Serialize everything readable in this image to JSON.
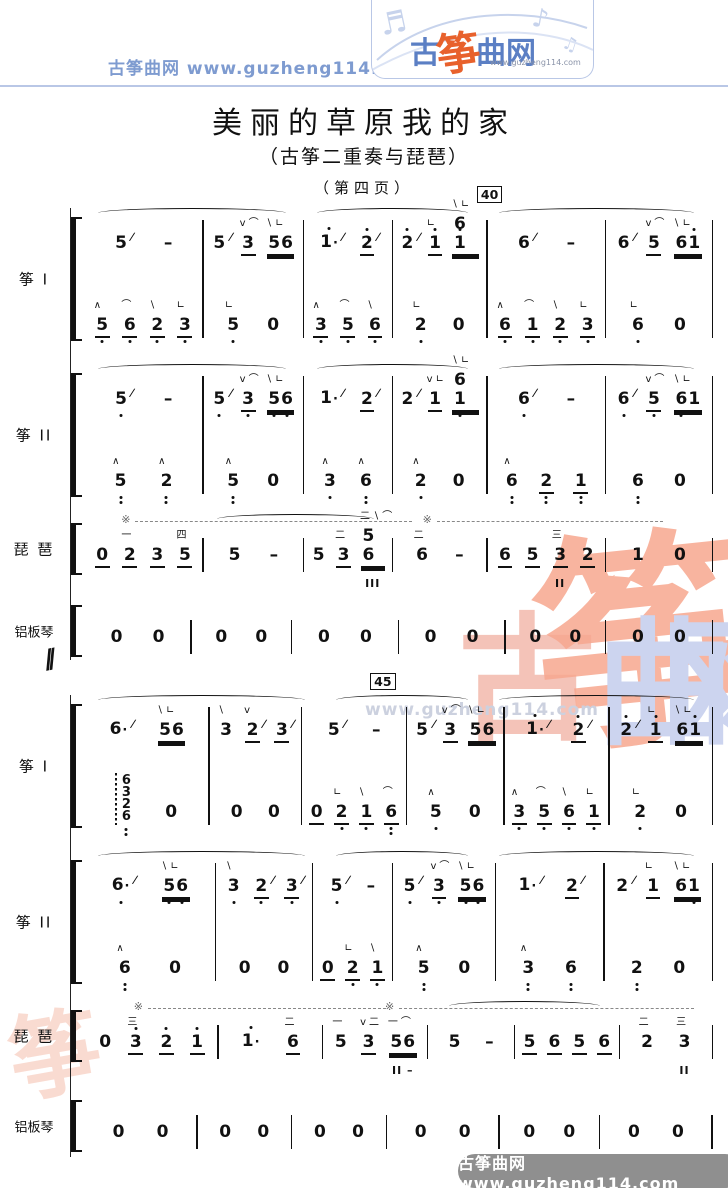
{
  "header": {
    "brand": "古筝曲网",
    "url": "www.guzheng114.com",
    "logo": {
      "gu": "古",
      "zheng": "筝",
      "quwang": "曲网",
      "url": "www.guzheng114.com"
    },
    "accent_blue": "#5b7fc4",
    "accent_orange": "#e8612c",
    "line_blue": "#b9c7e6"
  },
  "title": {
    "main": "美丽的草原我的家",
    "subtitle": "（古筝二重奏与琵琶）",
    "page_note": "（第四页）"
  },
  "watermark": {
    "gu": "古",
    "zheng": "筝",
    "qu": "曲",
    "wang": "网",
    "url": "www.guzheng114.com",
    "swirl": "筝",
    "pink": "#f4c3b8",
    "salmon": "#f7a78f",
    "lavender": "#ccd4ef"
  },
  "footer": {
    "text": "古筝曲网  www.guzheng114.com",
    "bg": "#8f8f8f"
  },
  "break_mark": "∕∕",
  "score": {
    "systems": [
      {
        "measure_box": {
          "text": "40",
          "before_measure": 4
        },
        "parts": [
          {
            "id": "zheng1",
            "label": "筝 I",
            "type": "grand",
            "slurs": [
              [
                0,
                1
              ],
              [
                2,
                3
              ],
              [
                4,
                5
              ]
            ],
            "upper": [
              [
                "5/",
                "-"
              ],
              [
                "5/",
                "{v⌒}3_",
                "{∖∟}56__"
              ],
              [
                "1'./",
                "2'_/"
              ],
              [
                "2'/",
                "{∟}1'_",
                "{∖∟}61'__"
              ],
              [
                "6/",
                "-"
              ],
              [
                "6/",
                "{v⌒}5_",
                "{∖∟}61'__"
              ]
            ],
            "lower": [
              [
                "{∧}5,_",
                "{⌒}6,_",
                "{∖}2,_",
                "{∟}3,_"
              ],
              [
                "{∟}5,",
                "0"
              ],
              [
                "{∧}3,_",
                "{⌒}5,_",
                "{∖}6,_"
              ],
              [
                "{∟}2,",
                "0"
              ],
              [
                "{∧}6,_",
                "{⌒}1,_",
                "{∖}2,_",
                "{∟}3,_"
              ],
              [
                "{∟}6,",
                "0"
              ]
            ]
          },
          {
            "id": "zheng2",
            "label": "筝 II",
            "type": "grand",
            "slurs": [
              [
                0,
                1
              ],
              [
                2,
                3
              ],
              [
                4,
                5
              ]
            ],
            "upper": [
              [
                "5,/",
                "-"
              ],
              [
                "5,/",
                "{v⌒}3,_",
                "{∖∟}5,6,__"
              ],
              [
                "1./",
                "2_/"
              ],
              [
                "2/",
                "{v∟}1_",
                "{∖∟}61,__"
              ],
              [
                "6,/",
                "-"
              ],
              [
                "6,/",
                "{v⌒}5,_",
                "{∖∟}6,1__"
              ]
            ],
            "lower": [
              [
                "{∧}5,,",
                "{∧}2,,"
              ],
              [
                "{∧}5,,",
                "0"
              ],
              [
                "{∧}3,",
                "{∧}6,,"
              ],
              [
                "{∧}2,",
                "0"
              ],
              [
                "{∧}6,,",
                "2,,_",
                "1,,_"
              ],
              [
                "6,,",
                "0"
              ]
            ]
          },
          {
            "id": "pipa",
            "label": "琵 琶",
            "type": "single",
            "slurs": [
              [
                1,
                2
              ]
            ],
            "pedals": [
              {
                "left": 8,
                "width": 44
              },
              {
                "left": 56,
                "width": 36
              }
            ],
            "line": [
              [
                "0_",
                "{一}2_",
                "3_",
                "{四}5_"
              ],
              [
                "5",
                "-"
              ],
              [
                "5",
                "{二}3_",
                {
                  "t": "{二∖⌒}56__",
                  "below": "III"
                }
              ],
              [
                "{二}6",
                "-"
              ],
              [
                "6_",
                "5_",
                {
                  "t": "{三}3_",
                  "below": "II"
                },
                "2_"
              ],
              [
                "1",
                "0"
              ]
            ]
          },
          {
            "id": "ban",
            "label": "铝板琴",
            "type": "single",
            "line": [
              [
                "0",
                "0"
              ],
              [
                "0",
                "0"
              ],
              [
                "0",
                "0"
              ],
              [
                "0",
                "0"
              ],
              [
                "0",
                "0"
              ],
              [
                "0",
                "0"
              ]
            ]
          }
        ]
      },
      {
        "measure_box": {
          "text": "45",
          "before_measure": 3
        },
        "parts": [
          {
            "id": "zheng1",
            "label": "筝 I",
            "type": "grand",
            "slurs": [
              [
                0,
                1
              ],
              [
                2,
                3
              ],
              [
                4,
                5
              ]
            ],
            "upper": [
              [
                "6./",
                "{∖∟}56__"
              ],
              [
                "{∖}3",
                "{v}2_/",
                "3_/"
              ],
              [
                "5/",
                "-"
              ],
              [
                "5/",
                "{v⌒}3_",
                "{∖∟}56__"
              ],
              [
                "1'./",
                "2'_/"
              ],
              [
                "2'/",
                "{∟}1'_",
                "{∖∟}61'__"
              ]
            ],
            "lower": [
              [
                {
                  "chord": [
                    "6",
                    "3",
                    "2",
                    "6,,"
                  ]
                },
                "0"
              ],
              [
                "0",
                "0"
              ],
              [
                "0_",
                "{∟}2,_",
                "{∖}1,_",
                "{⌒}6,,_"
              ],
              [
                "{∧}5,",
                "0"
              ],
              [
                "{∧}3,_",
                "{⌒}5,_",
                "{∖}6,_",
                "{∟}1,_"
              ],
              [
                "{∟}2,",
                "0"
              ]
            ]
          },
          {
            "id": "zheng2",
            "label": "筝 II",
            "type": "grand",
            "slurs": [
              [
                0,
                1
              ],
              [
                2,
                3
              ],
              [
                4,
                5
              ]
            ],
            "upper": [
              [
                "6,./",
                "{∖∟}5,6,__"
              ],
              [
                "{∖}3,",
                "2,_/",
                "3,_/"
              ],
              [
                "5,/",
                "-"
              ],
              [
                "5,/",
                "{v⌒}3,_",
                "{∖∟}5,6,__"
              ],
              [
                "1./",
                "2_/"
              ],
              [
                "2/",
                "{∟}1_",
                "{∖∟}61,__"
              ]
            ],
            "lower": [
              [
                "{∧}6,,",
                "0"
              ],
              [
                "0",
                "0"
              ],
              [
                "0_",
                "{∟}2,_",
                "{∖}1,_"
              ],
              [
                "{∧}5,,",
                "0"
              ],
              [
                "{∧}3,,",
                "6,,"
              ],
              [
                "2,,",
                "0"
              ]
            ]
          },
          {
            "id": "pipa",
            "label": "琵 琶",
            "type": "single",
            "slurs": [
              [
                3,
                4
              ]
            ],
            "pedals": [
              {
                "left": 10,
                "width": 38
              },
              {
                "left": 50,
                "width": 47
              }
            ],
            "line": [
              [
                "0",
                "{三}3'_",
                "2'_",
                "1'_"
              ],
              [
                "1'.",
                "{二}6_"
              ],
              [
                "{一}5",
                "{v二}3_",
                {
                  "t": "{一⌒}56__",
                  "below": "II –"
                }
              ],
              [
                "5",
                "-"
              ],
              [
                "5_",
                "6_",
                "5_",
                "6_"
              ],
              [
                "{二}2",
                {
                  "t": "{三}3",
                  "below": "II"
                }
              ]
            ]
          },
          {
            "id": "ban",
            "label": "铝板琴",
            "type": "single",
            "line": [
              [
                "0",
                "0"
              ],
              [
                "0",
                "0"
              ],
              [
                "0",
                "0"
              ],
              [
                "0",
                "0"
              ],
              [
                "0",
                "0"
              ],
              [
                "0",
                "0"
              ]
            ]
          }
        ]
      }
    ]
  }
}
